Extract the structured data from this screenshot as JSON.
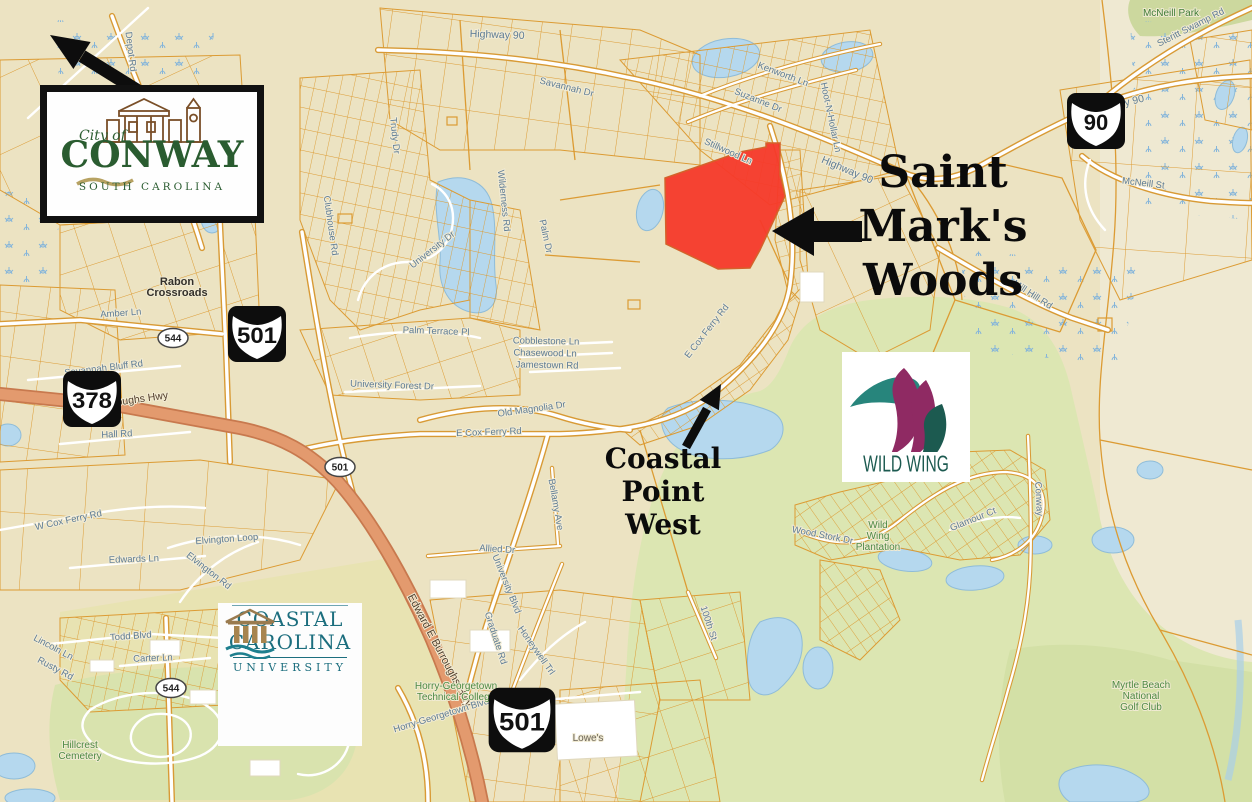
{
  "map": {
    "region_title": "Conway South Carolina parcel map",
    "colors": {
      "base": "#ece3c2",
      "parcel_line": "#dc9b33",
      "water": "#b5d8ee",
      "golf_green": "#dce6b2",
      "highway_salmon": "#e39a6e",
      "road_label": "#5e7c95",
      "place_label_green": "#4d8a44",
      "highlight_red": "#f5392a"
    },
    "shields": [
      {
        "type": "us-route",
        "label": "501",
        "x": 257,
        "y": 334,
        "scale": 1
      },
      {
        "type": "us-route",
        "label": "378",
        "x": 92,
        "y": 399,
        "scale": 1
      },
      {
        "type": "us-route",
        "label": "90",
        "x": 1096,
        "y": 121,
        "scale": 1
      },
      {
        "type": "us-route",
        "label": "501",
        "x": 522,
        "y": 720,
        "scale": 1.15
      },
      {
        "type": "state-oval",
        "label": "544",
        "x": 173,
        "y": 338
      },
      {
        "type": "state-oval",
        "label": "544",
        "x": 171,
        "y": 688
      },
      {
        "type": "state-oval",
        "label": "501",
        "x": 340,
        "y": 467
      }
    ],
    "road_labels": [
      {
        "text": "Highway 90",
        "x": 497,
        "y": 38,
        "rot": 2,
        "size": 10.5
      },
      {
        "text": "Highway 90",
        "x": 1118,
        "y": 108,
        "rot": -14,
        "size": 10.5
      },
      {
        "text": "Highway 90",
        "x": 846,
        "y": 173,
        "rot": 23,
        "size": 10.5
      },
      {
        "text": "Steritt Swamp Rd",
        "x": 1192,
        "y": 30,
        "rot": -27
      },
      {
        "text": "McNeill St",
        "x": 1143,
        "y": 186,
        "rot": 7
      },
      {
        "text": "Kenworth Ln",
        "x": 782,
        "y": 77,
        "rot": 21
      },
      {
        "text": "Suzanne Dr",
        "x": 757,
        "y": 103,
        "rot": 22
      },
      {
        "text": "Hoot-N-Hollar Ln",
        "x": 828,
        "y": 118,
        "rot": 78
      },
      {
        "text": "Stillwood Ln",
        "x": 727,
        "y": 154,
        "rot": 24
      },
      {
        "text": "Mill Hill Rd",
        "x": 1031,
        "y": 297,
        "rot": 33
      },
      {
        "text": "Amber Ln",
        "x": 121,
        "y": 316,
        "rot": -4
      },
      {
        "text": "Savannah Bluff Rd",
        "x": 104,
        "y": 371,
        "rot": -7
      },
      {
        "text": "E Burroughs Hwy",
        "x": 128,
        "y": 404,
        "rot": -8,
        "color": "#54402e",
        "size": 10.5
      },
      {
        "text": "Edward E Burroughs Hwy",
        "x": 437,
        "y": 652,
        "rot": 62,
        "color": "#54402e",
        "size": 11
      },
      {
        "text": "Hall Rd",
        "x": 117,
        "y": 437,
        "rot": -3
      },
      {
        "text": "W Cox Ferry Rd",
        "x": 69,
        "y": 523,
        "rot": -12
      },
      {
        "text": "Edwards Ln",
        "x": 134,
        "y": 562,
        "rot": -2
      },
      {
        "text": "Elvington Loop",
        "x": 227,
        "y": 542,
        "rot": -4
      },
      {
        "text": "Elvington Rd",
        "x": 207,
        "y": 573,
        "rot": 38
      },
      {
        "text": "Cobblestone Ln",
        "x": 546,
        "y": 344,
        "rot": 1
      },
      {
        "text": "Chasewood Ln",
        "x": 545,
        "y": 356,
        "rot": 1
      },
      {
        "text": "Jamestown Rd",
        "x": 547,
        "y": 368,
        "rot": 1
      },
      {
        "text": "University Forest Dr",
        "x": 392,
        "y": 388,
        "rot": 2
      },
      {
        "text": "Old Magnolia Dr",
        "x": 532,
        "y": 412,
        "rot": -8
      },
      {
        "text": "E Cox Ferry Rd",
        "x": 489,
        "y": 435,
        "rot": -2
      },
      {
        "text": "E Cox Ferry Rd",
        "x": 709,
        "y": 333,
        "rot": -52
      },
      {
        "text": "Bellamy Ave",
        "x": 553,
        "y": 505,
        "rot": 80
      },
      {
        "text": "Allied Dr",
        "x": 497,
        "y": 552,
        "rot": 4
      },
      {
        "text": "University Blvd",
        "x": 504,
        "y": 585,
        "rot": 68
      },
      {
        "text": "Graduate Rd",
        "x": 493,
        "y": 639,
        "rot": 72
      },
      {
        "text": "Honeywell Trl",
        "x": 534,
        "y": 652,
        "rot": 55
      },
      {
        "text": "Horry-Georgetown Blvd",
        "x": 442,
        "y": 718,
        "rot": -17
      },
      {
        "text": "Todd Blvd",
        "x": 131,
        "y": 639,
        "rot": -4
      },
      {
        "text": "Carter Ln",
        "x": 153,
        "y": 661,
        "rot": -2
      },
      {
        "text": "Lincoln Ln",
        "x": 52,
        "y": 650,
        "rot": 28
      },
      {
        "text": "Rusty Rd",
        "x": 54,
        "y": 671,
        "rot": 28
      },
      {
        "text": "Wood Stork Dr",
        "x": 822,
        "y": 538,
        "rot": 11
      },
      {
        "text": "Glamour Ct",
        "x": 974,
        "y": 522,
        "rot": -22
      },
      {
        "text": "Conway",
        "x": 1036,
        "y": 499,
        "rot": 87
      },
      {
        "text": "100th St",
        "x": 706,
        "y": 624,
        "rot": 72
      },
      {
        "text": "Depot Rd",
        "x": 128,
        "y": 52,
        "rot": 83
      },
      {
        "text": "Trudy Dr",
        "x": 392,
        "y": 136,
        "rot": 84
      },
      {
        "text": "Clubhouse Rd",
        "x": 328,
        "y": 226,
        "rot": 82
      },
      {
        "text": "University Dr",
        "x": 434,
        "y": 252,
        "rot": -38
      },
      {
        "text": "Wilderness Rd",
        "x": 501,
        "y": 201,
        "rot": 84
      },
      {
        "text": "Palm Dr",
        "x": 543,
        "y": 237,
        "rot": 78
      },
      {
        "text": "Palm Terrace Pl",
        "x": 436,
        "y": 334,
        "rot": 2
      },
      {
        "text": "Savannah Dr",
        "x": 566,
        "y": 90,
        "rot": 14
      }
    ],
    "place_labels": [
      {
        "lines": [
          "McNeill Park"
        ],
        "x": 1171,
        "y": 16,
        "color": "#3f7d37"
      },
      {
        "lines": [
          "Rabon",
          "Crossroads"
        ],
        "x": 177,
        "y": 285,
        "color": "#33302a",
        "size": 11,
        "bold": true
      },
      {
        "lines": [
          "Hillcrest",
          "Cemetery"
        ],
        "x": 80,
        "y": 748,
        "color": "#4d8a44"
      },
      {
        "lines": [
          "Horry-Georgetown",
          "Technical College"
        ],
        "x": 456,
        "y": 689,
        "color": "#4d8a44"
      },
      {
        "lines": [
          "Wild",
          "Wing",
          "Plantation"
        ],
        "x": 878,
        "y": 528,
        "color": "#4d8a44"
      },
      {
        "lines": [
          "Myrtle Beach",
          "National",
          "Golf Club"
        ],
        "x": 1141,
        "y": 688,
        "color": "#4d8a44"
      },
      {
        "lines": [
          "Lowe's"
        ],
        "x": 588,
        "y": 741,
        "color": "#6b6458"
      }
    ]
  },
  "annotations": {
    "site_label": {
      "lines": [
        "Saint",
        "Mark's",
        "Woods"
      ]
    },
    "coastal_point": {
      "lines": [
        "Coastal Point",
        "West"
      ]
    }
  },
  "logos": {
    "conway": {
      "city_of": "City of",
      "name": "CONWAY",
      "state": "SOUTH CAROLINA"
    },
    "wild_wing": {
      "name": "WILD WING"
    },
    "ccu": {
      "line1": "COASTAL",
      "line2": "CAROLINA",
      "line3": "UNIVERSITY"
    }
  }
}
